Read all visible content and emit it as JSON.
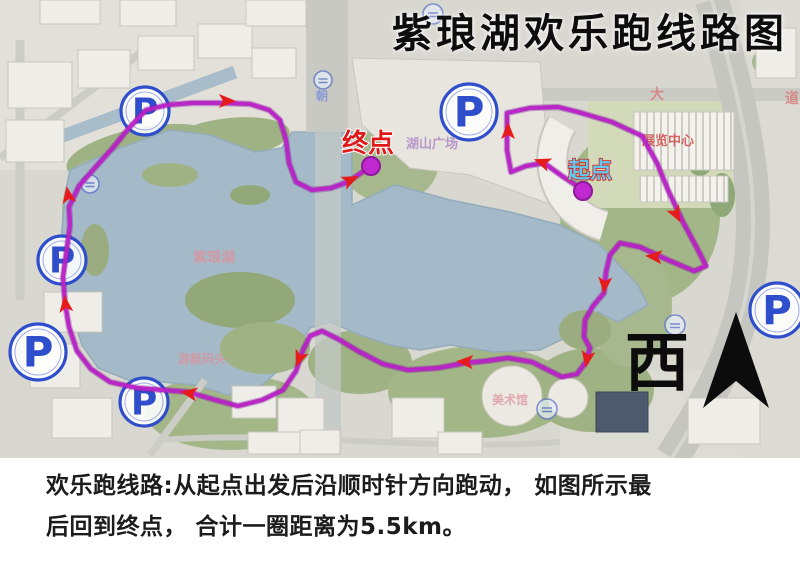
{
  "title": "紫琅湖欢乐跑线路图",
  "caption": {
    "line1": "欢乐跑线路:从起点出发后沿顺时针方向跑动， 如图所示最",
    "line2": "后回到终点， 合计一圈距离为5.5km。"
  },
  "compass": {
    "label": "西"
  },
  "colors": {
    "route": "#b822c6",
    "route_underlay": "#7c1596",
    "arrow": "#e61c1c",
    "parking_blue": "#2f4ecc",
    "start_text": "#62c8ee",
    "start_outline": "#d92020",
    "end_text": "#e01818",
    "dot": "#c128cf",
    "lake": "#a5bac8"
  },
  "route": {
    "distance_label": "5.5km",
    "path": "M583,190 L562,176 L544,163 L526,166 L511,172 L507,150 L507,113 L530,108 L558,107 L578,112 L612,122 L642,136 L657,163 L668,190 L683,222 L698,250 L706,266 L694,271 L668,260 L640,247 L620,243 L610,255 L606,272 L604,293 L593,306 L585,320 L584,337 L590,348 L586,362 L577,374 L562,377 L548,370 L532,362 L508,358 L486,361 L465,363 L438,368 L408,370 L383,364 L358,351 L338,339 L322,331 L310,336 L303,350 L296,371 L283,390 L262,400 L238,406 L212,399 L188,392 L163,390 L137,388 L110,382 L91,369 L77,351 L69,327 L65,303 L63,277 L67,248 L70,225 L69,207 L79,186 L93,170 L111,150 L129,128 L146,110 L167,105 L192,103 L222,103 L250,104 L269,110 L280,120 L286,140 L289,163 L296,182 L312,190 L331,188 L348,182 L361,173 L371,166",
    "start": {
      "label": "起点",
      "x": 583,
      "y": 191,
      "label_x": 590,
      "label_y": 178
    },
    "end": {
      "label": "终点",
      "x": 371,
      "y": 166,
      "label_x": 368,
      "label_y": 152
    },
    "arrows": [
      {
        "x": 222,
        "y": 101,
        "deg": 0
      },
      {
        "x": 346,
        "y": 182,
        "deg": -25
      },
      {
        "x": 508,
        "y": 136,
        "deg": -90
      },
      {
        "x": 547,
        "y": 164,
        "deg": -160
      },
      {
        "x": 674,
        "y": 210,
        "deg": 62
      },
      {
        "x": 659,
        "y": 257,
        "deg": -175
      },
      {
        "x": 605,
        "y": 280,
        "deg": 95
      },
      {
        "x": 588,
        "y": 354,
        "deg": 100
      },
      {
        "x": 470,
        "y": 362,
        "deg": 183
      },
      {
        "x": 301,
        "y": 354,
        "deg": 112
      },
      {
        "x": 194,
        "y": 394,
        "deg": 190
      },
      {
        "x": 66,
        "y": 309,
        "deg": -97
      },
      {
        "x": 69,
        "y": 200,
        "deg": -100
      }
    ]
  },
  "parking": {
    "glyph": "P",
    "positions": [
      {
        "x": 145,
        "y": 111,
        "r": 24
      },
      {
        "x": 62,
        "y": 260,
        "r": 24
      },
      {
        "x": 38,
        "y": 352,
        "r": 28
      },
      {
        "x": 144,
        "y": 402,
        "r": 24
      },
      {
        "x": 469,
        "y": 112,
        "r": 28
      },
      {
        "x": 777,
        "y": 310,
        "r": 27
      }
    ]
  },
  "small_icons": [
    {
      "x": 90,
      "y": 184,
      "r": 9
    },
    {
      "x": 323,
      "y": 80,
      "r": 9
    },
    {
      "x": 433,
      "y": 14,
      "r": 10
    },
    {
      "x": 675,
      "y": 325,
      "r": 10
    },
    {
      "x": 547,
      "y": 409,
      "r": 10
    }
  ],
  "map_labels": [
    {
      "text": "展览中心",
      "x": 668,
      "y": 145,
      "size": 13,
      "color": "#cf4f4f",
      "opacity": 0.85
    },
    {
      "text": "湖山广场",
      "x": 432,
      "y": 148,
      "size": 13,
      "color": "#b48fc8",
      "opacity": 0.9
    },
    {
      "text": "紫琅湖",
      "x": 214,
      "y": 262,
      "size": 14,
      "color": "#e08f9a",
      "opacity": 0.75
    },
    {
      "text": "游艇码头",
      "x": 202,
      "y": 363,
      "size": 12,
      "color": "#dd8f9a",
      "opacity": 0.7
    },
    {
      "text": "美术馆",
      "x": 510,
      "y": 404,
      "size": 12,
      "color": "#dd8f9a",
      "opacity": 0.7
    },
    {
      "text": "大",
      "x": 657,
      "y": 99,
      "size": 14,
      "color": "#d97a7a",
      "opacity": 0.8
    },
    {
      "text": "道",
      "x": 792,
      "y": 103,
      "size": 14,
      "color": "#d97a7a",
      "opacity": 0.8
    },
    {
      "text": "朝",
      "x": 322,
      "y": 100,
      "size": 12,
      "color": "#7a8fd9",
      "opacity": 0.8
    }
  ]
}
